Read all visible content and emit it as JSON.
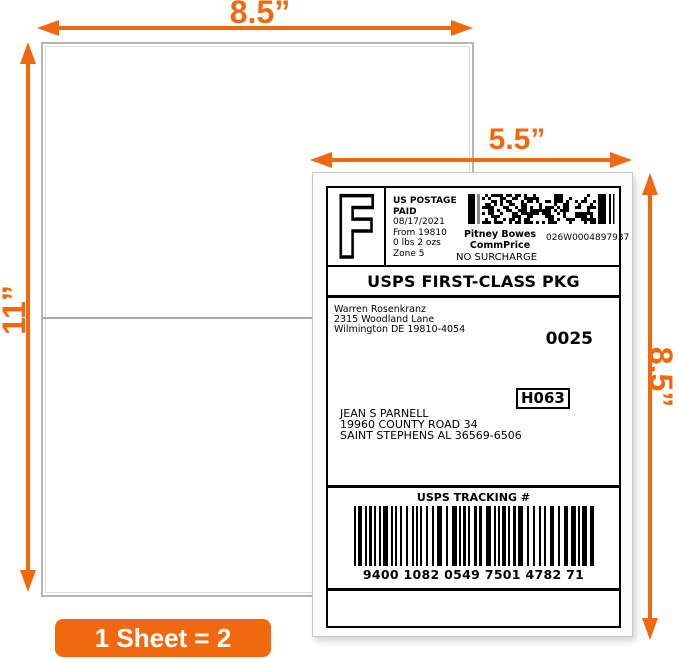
{
  "colors": {
    "accent_orange": "#f0690f",
    "label_ink": "#000000"
  },
  "dimensions": {
    "sheet_width": "8.5”",
    "sheet_height": "11”",
    "label_width": "5.5”",
    "label_height": "8.5”"
  },
  "badge": {
    "text": "1 Sheet = 2 Labels"
  },
  "shipping_label": {
    "postage": {
      "letter": "F",
      "line1": "US POSTAGE",
      "line2": "PAID",
      "date": "08/17/2021",
      "from": "From 19810",
      "weight": "0 lbs 2 ozs",
      "zone": "Zone 5",
      "meter_name1": "Pitney Bowes",
      "meter_name2": "CommPrice",
      "meter_number": "026W0004897937",
      "surcharge": "NO SURCHARGE"
    },
    "service": "USPS FIRST-CLASS PKG",
    "sender": [
      "Warren Rosenkranz",
      "2315 Woodland Lane",
      "Wilmington DE 19810-4054"
    ],
    "batch_number": "0025",
    "sort_code": "H063",
    "recipient": [
      "JEAN S PARNELL",
      "19960 COUNTY ROAD 34",
      "SAINT STEPHENS AL 36569-6506"
    ],
    "tracking": {
      "header": "USPS TRACKING #",
      "number": "9400 1082 0549 7501 4782 71"
    }
  }
}
